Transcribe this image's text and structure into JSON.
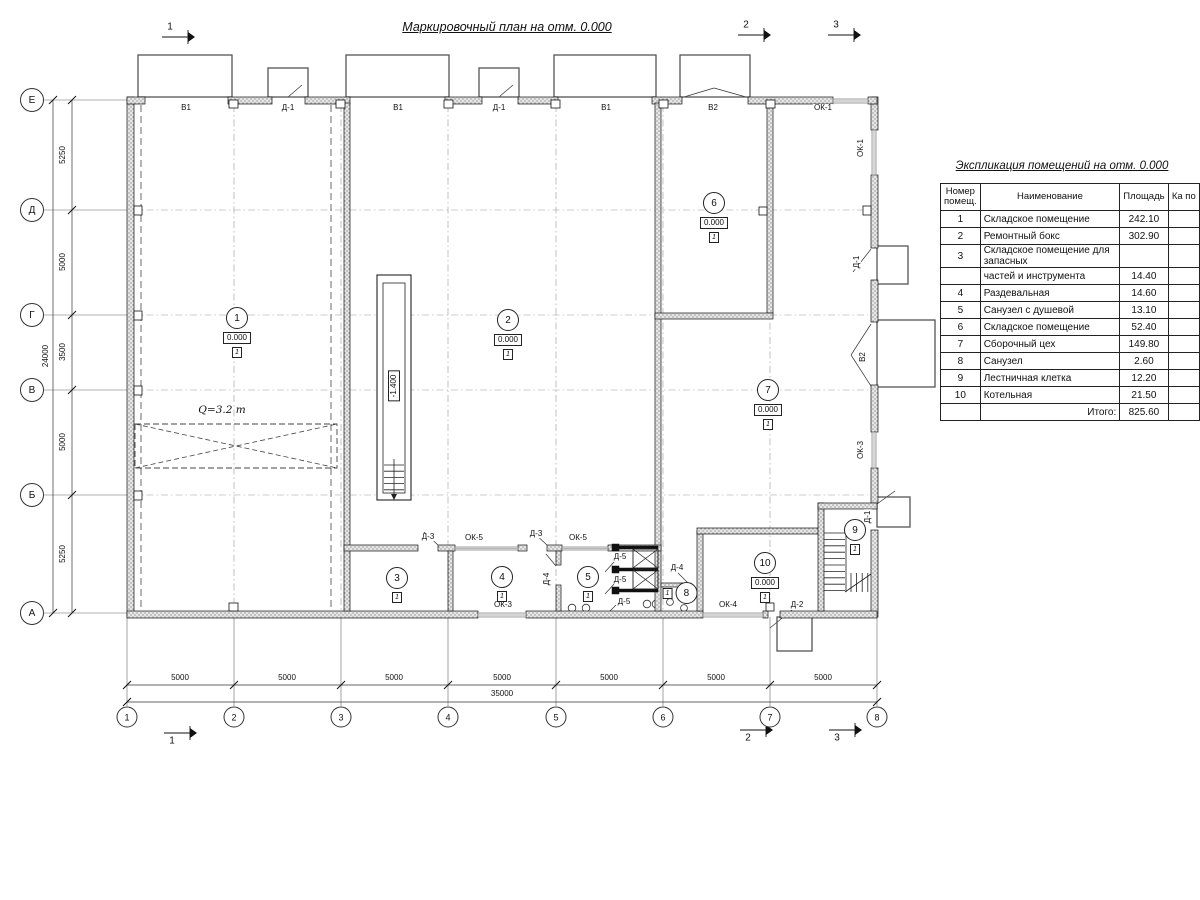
{
  "plan_title": "Маркировочный план на отм. 0.000",
  "table": {
    "title": "Экспликация помещений на отм. 0.000",
    "headers": {
      "num": "Номер помещ.",
      "name": "Наименование",
      "area": "Площадь",
      "extra": "Ка по"
    },
    "rows": [
      {
        "num": "1",
        "name": "Складское помещение",
        "area": "242.10"
      },
      {
        "num": "2",
        "name": "Ремонтный бокс",
        "area": "302.90"
      },
      {
        "num": "3",
        "name": "Складское помещение для запасных",
        "area": ""
      },
      {
        "num": "",
        "name": "частей и инструмента",
        "area": "14.40"
      },
      {
        "num": "4",
        "name": "Раздевальная",
        "area": "14.60"
      },
      {
        "num": "5",
        "name": "Санузел с душевой",
        "area": "13.10"
      },
      {
        "num": "6",
        "name": "Складское помещение",
        "area": "52.40"
      },
      {
        "num": "7",
        "name": "Сборочный цех",
        "area": "149.80"
      },
      {
        "num": "8",
        "name": "Санузел",
        "area": "2.60"
      },
      {
        "num": "9",
        "name": "Лестничная клетка",
        "area": "12.20"
      },
      {
        "num": "10",
        "name": "Котельная",
        "area": "21.50"
      },
      {
        "num": "",
        "name": "Итого:",
        "area": "825.60",
        "total": true
      }
    ]
  },
  "grid": {
    "rows": [
      {
        "label": "Е",
        "y": 100
      },
      {
        "label": "Д",
        "y": 210
      },
      {
        "label": "Г",
        "y": 315
      },
      {
        "label": "В",
        "y": 390
      },
      {
        "label": "Б",
        "y": 495
      },
      {
        "label": "А",
        "y": 613
      }
    ],
    "cols": [
      {
        "label": "1",
        "x": 127
      },
      {
        "label": "2",
        "x": 234
      },
      {
        "label": "3",
        "x": 341
      },
      {
        "label": "4",
        "x": 448
      },
      {
        "label": "5",
        "x": 556
      },
      {
        "label": "6",
        "x": 663
      },
      {
        "label": "7",
        "x": 770
      },
      {
        "label": "8",
        "x": 877
      }
    ],
    "dims": [
      {
        "text": "5250",
        "x": 63,
        "y": 155,
        "rot": 1
      },
      {
        "text": "5000",
        "x": 63,
        "y": 262,
        "rot": 1
      },
      {
        "text": "3500",
        "x": 63,
        "y": 352,
        "rot": 1
      },
      {
        "text": "5000",
        "x": 63,
        "y": 442,
        "rot": 1
      },
      {
        "text": "5250",
        "x": 63,
        "y": 554,
        "rot": 1
      },
      {
        "text": "24000",
        "x": 46,
        "y": 356,
        "rot": 1
      },
      {
        "text": "5000",
        "x": 180,
        "y": 678
      },
      {
        "text": "5000",
        "x": 287,
        "y": 678
      },
      {
        "text": "5000",
        "x": 394,
        "y": 678
      },
      {
        "text": "5000",
        "x": 502,
        "y": 678
      },
      {
        "text": "5000",
        "x": 609,
        "y": 678
      },
      {
        "text": "5000",
        "x": 716,
        "y": 678
      },
      {
        "text": "5000",
        "x": 823,
        "y": 678
      },
      {
        "text": "35000",
        "x": 502,
        "y": 694
      }
    ]
  },
  "sections": [
    {
      "label": "1",
      "x": 170,
      "y": 27
    },
    {
      "label": "2",
      "x": 746,
      "y": 25
    },
    {
      "label": "3",
      "x": 836,
      "y": 25
    },
    {
      "label": "1",
      "x": 172,
      "y": 741
    },
    {
      "label": "2",
      "x": 748,
      "y": 738
    },
    {
      "label": "3",
      "x": 837,
      "y": 738
    }
  ],
  "rooms": [
    {
      "n": "1",
      "x": 237,
      "y": 307,
      "elev": "0.000",
      "floor": "1"
    },
    {
      "n": "2",
      "x": 508,
      "y": 309,
      "elev": "0.000",
      "floor": "1"
    },
    {
      "n": "3",
      "x": 397,
      "y": 567,
      "floor": "1"
    },
    {
      "n": "4",
      "x": 502,
      "y": 566,
      "floor": "1"
    },
    {
      "n": "5",
      "x": 588,
      "y": 566,
      "floor": "1"
    },
    {
      "n": "6",
      "x": 714,
      "y": 192,
      "elev": "0.000",
      "floor": "1"
    },
    {
      "n": "7",
      "x": 768,
      "y": 379,
      "elev": "0.000",
      "floor": "1"
    },
    {
      "n": "8",
      "x": 680,
      "y": 593,
      "floor": "1",
      "side": true
    },
    {
      "n": "9",
      "x": 855,
      "y": 519,
      "floor": "1"
    },
    {
      "n": "10",
      "x": 765,
      "y": 552,
      "elev": "0.000",
      "floor": "1"
    }
  ],
  "labels": [
    {
      "t": "В1",
      "x": 186,
      "y": 108
    },
    {
      "t": "Д-1",
      "x": 288,
      "y": 108
    },
    {
      "t": "В1",
      "x": 398,
      "y": 108
    },
    {
      "t": "Д-1",
      "x": 499,
      "y": 108
    },
    {
      "t": "В1",
      "x": 606,
      "y": 108
    },
    {
      "t": "В2",
      "x": 713,
      "y": 108
    },
    {
      "t": "ОК-1",
      "x": 823,
      "y": 108
    },
    {
      "t": "ОК-1",
      "x": 861,
      "y": 148,
      "rot": 1
    },
    {
      "t": "Д-1",
      "x": 857,
      "y": 262,
      "rot": 1
    },
    {
      "t": "В2",
      "x": 863,
      "y": 357,
      "rot": 1
    },
    {
      "t": "ОК-3",
      "x": 861,
      "y": 450,
      "rot": 1
    },
    {
      "t": "Д-1",
      "x": 868,
      "y": 517,
      "rot": 1
    },
    {
      "t": "Д-3",
      "x": 428,
      "y": 537
    },
    {
      "t": "ОК-5",
      "x": 474,
      "y": 538
    },
    {
      "t": "Д-3",
      "x": 536,
      "y": 534
    },
    {
      "t": "ОК-5",
      "x": 578,
      "y": 538
    },
    {
      "t": "Д-4",
      "x": 547,
      "y": 579,
      "rot": 1
    },
    {
      "t": "Д-5",
      "x": 620,
      "y": 557
    },
    {
      "t": "Д-5",
      "x": 620,
      "y": 580
    },
    {
      "t": "Д-5",
      "x": 624,
      "y": 602
    },
    {
      "t": "Д-4",
      "x": 677,
      "y": 568
    },
    {
      "t": "ОК-3",
      "x": 503,
      "y": 605
    },
    {
      "t": "ОК-4",
      "x": 728,
      "y": 605
    },
    {
      "t": "Д-2",
      "x": 797,
      "y": 605
    }
  ],
  "crane": {
    "label": "Q=3.2 т",
    "x": 222,
    "y": 410
  },
  "pit": {
    "label": "-1.400",
    "x": 394,
    "y": 386
  }
}
